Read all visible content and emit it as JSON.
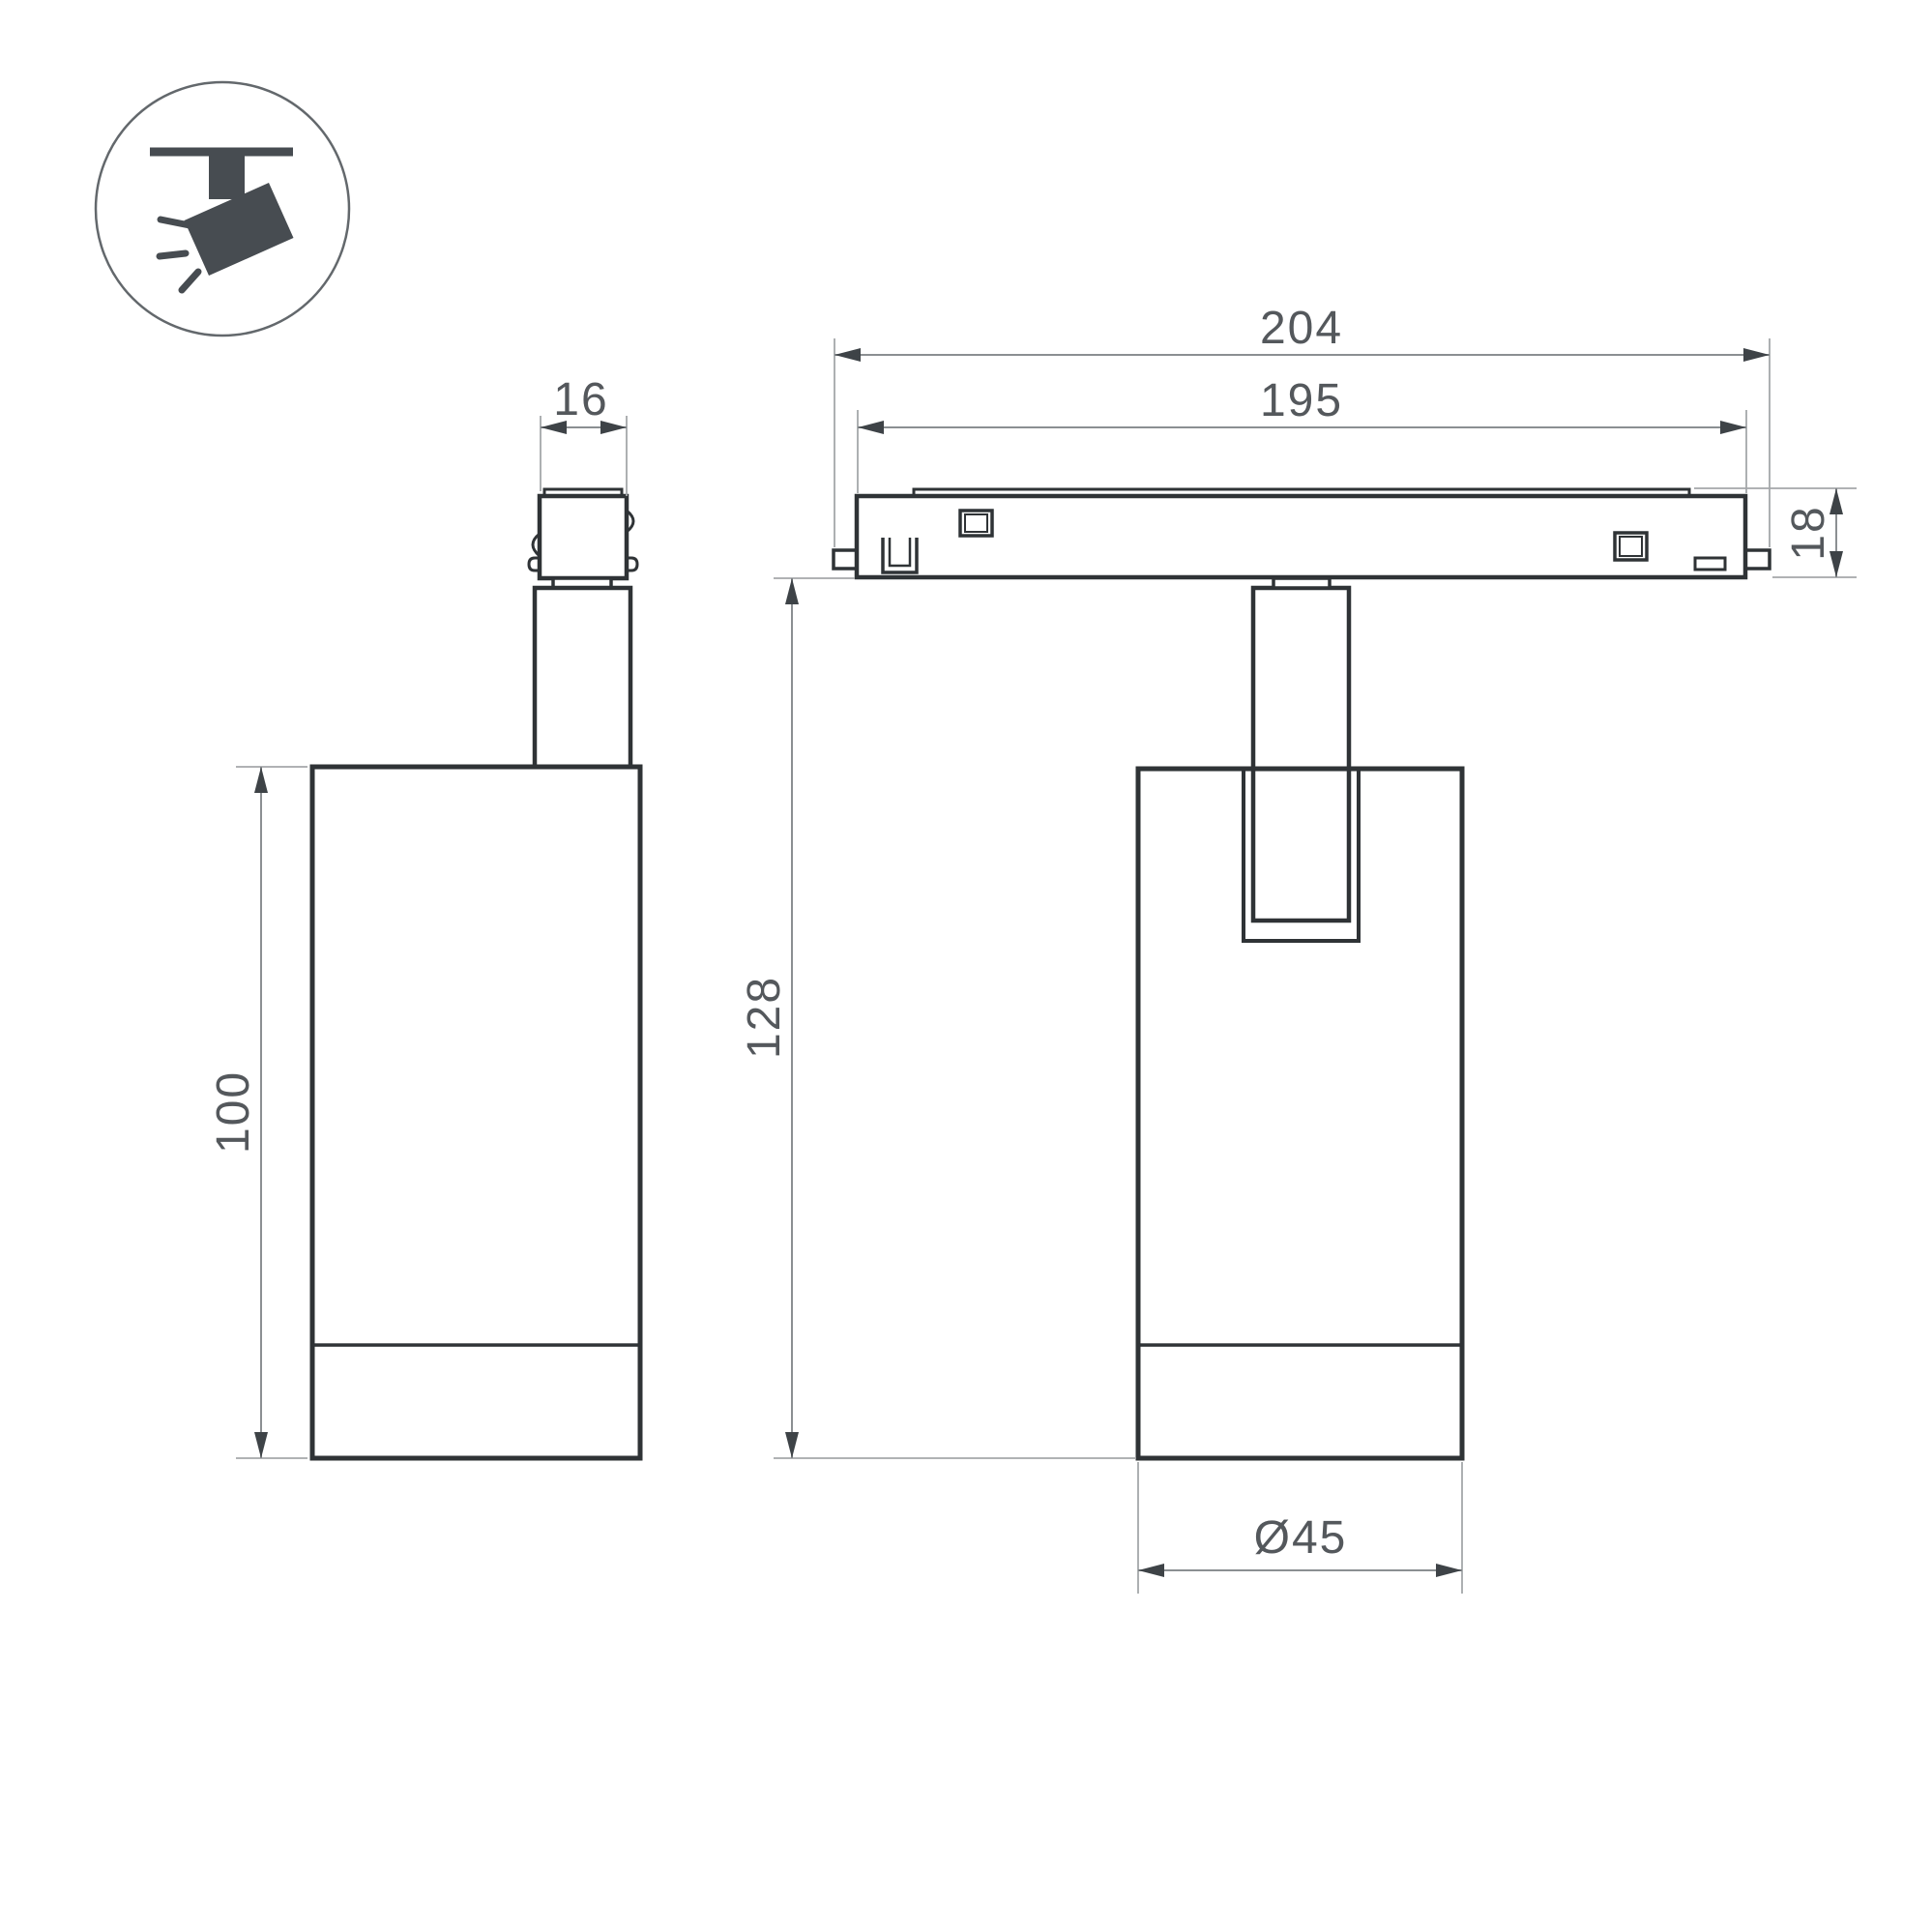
{
  "title": "Track spotlight dimension drawing",
  "icon": {
    "name": "ceiling-track-spotlight-icon"
  },
  "views": {
    "side_view": "spotlight side view",
    "front_view": "spotlight front view on track"
  },
  "dimensions": {
    "adapter_width": "16",
    "body_height": "100",
    "overall_length": "204",
    "rail_length": "195",
    "track_height": "18",
    "overall_height": "128",
    "body_diameter": "Ø45"
  },
  "colors": {
    "background": "#ffffff",
    "outline": "#2f3336",
    "dimension_line": "#8b8f92",
    "extension_line": "#a4a7aa",
    "arrow": "#3e4347",
    "dimension_text": "#54585c",
    "icon": "#474c51",
    "icon_circle": "#63686c"
  }
}
